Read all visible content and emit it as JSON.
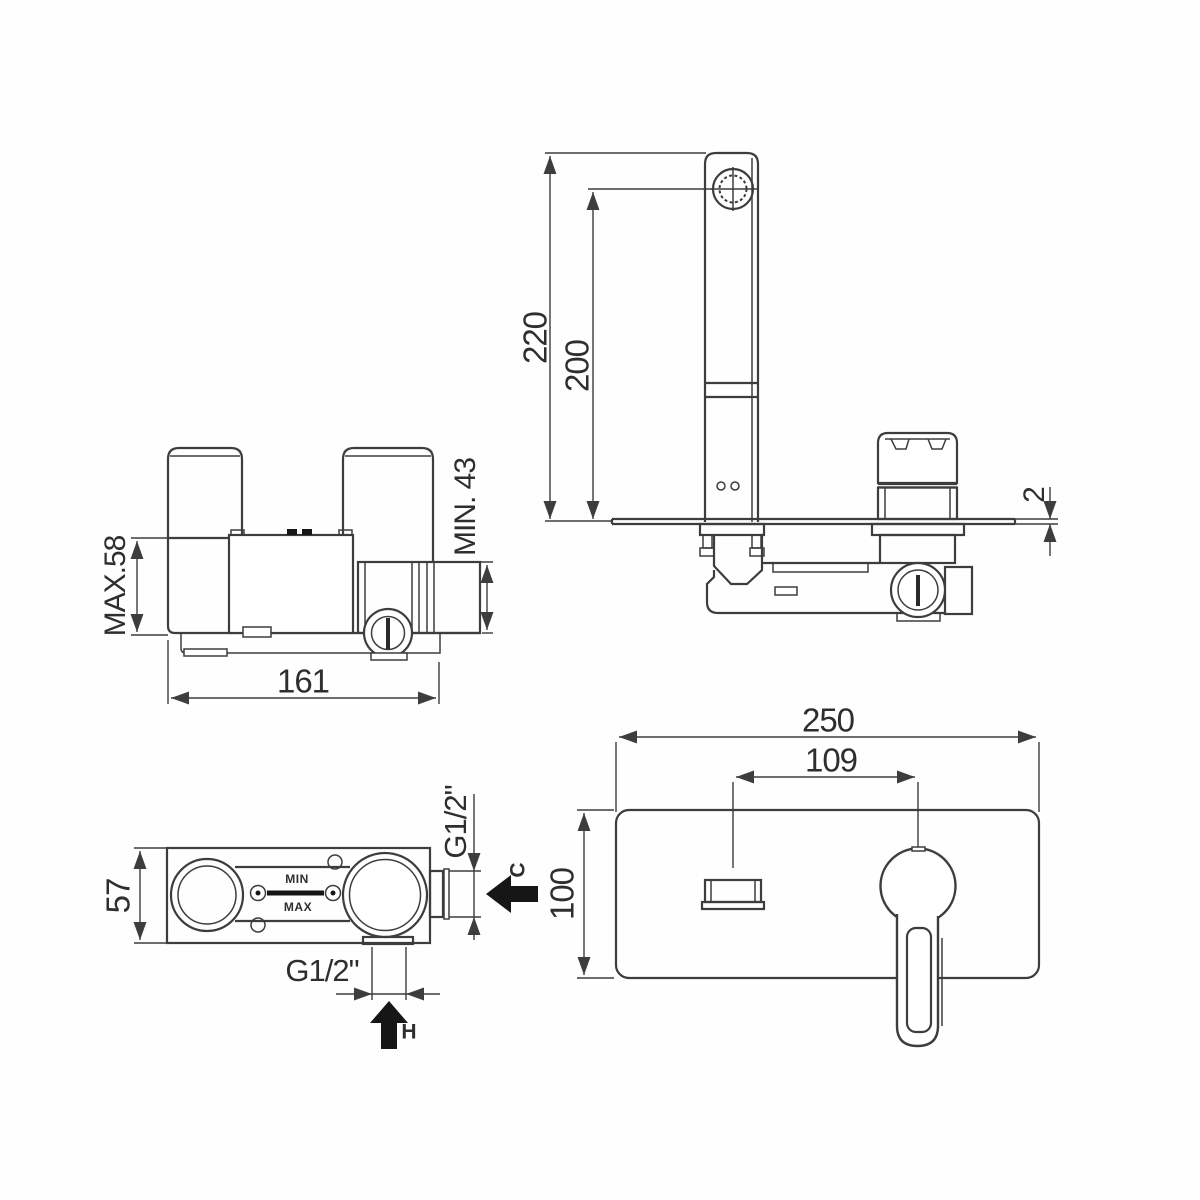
{
  "title": "Wall-mounted basin mixer installation drawing",
  "colors": {
    "line": "#3d3d3d",
    "dark_fill": "#161616",
    "background": "#ffffff"
  },
  "side_view": {
    "dim_total_height": "220",
    "dim_spout_height": "200",
    "dim_plate_thickness": "2"
  },
  "rear_view": {
    "dim_max_depth": "MAX.58",
    "dim_min_depth": "MIN. 43",
    "dim_width": "161"
  },
  "top_view": {
    "dim_depth": "57",
    "dim_cold_thread": "G1/2\"",
    "cold_arrow_label": "C",
    "dim_hot_thread": "G1/2\"",
    "hot_arrow_label": "H",
    "min_label": "MIN",
    "max_label": "MAX"
  },
  "front_view": {
    "dim_plate_width": "250",
    "dim_spout_to_handle": "109",
    "dim_plate_height": "100"
  }
}
